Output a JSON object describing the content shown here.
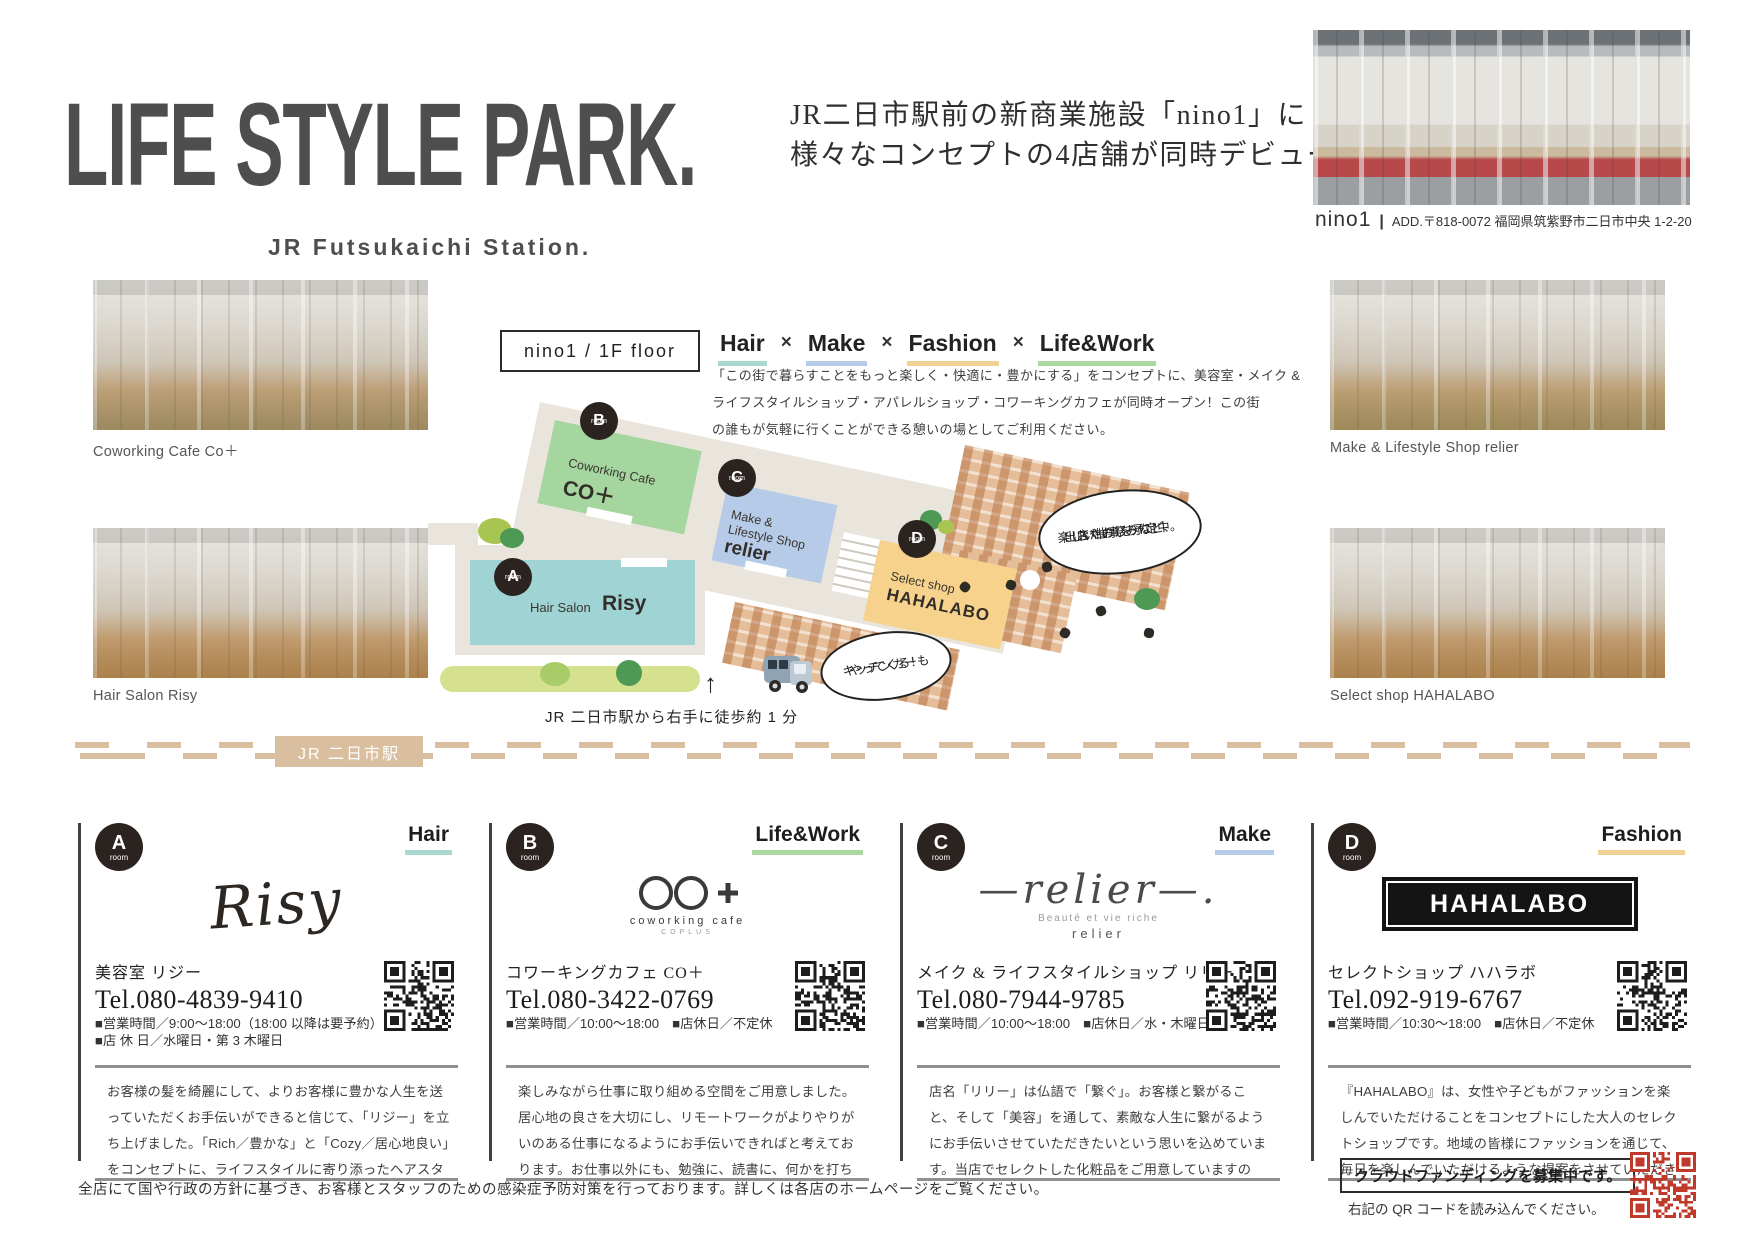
{
  "theme": {
    "ink": "#4e4e4e",
    "hair": "#a8d8d0",
    "make": "#b6cbe8",
    "fashion": "#f0d294",
    "lifework": "#abd8a0",
    "room_a": "#9fd3d4",
    "room_b": "#a5d6a0",
    "room_c": "#b6cbe8",
    "room_d": "#f6d28c",
    "station": "#d9bf9f",
    "qr_dark": "#1d1d1b",
    "qr_red": "#c0392b"
  },
  "header": {
    "title": "LIFE STYLE PARK.",
    "subtitle": "JR Futsukaichi Station.",
    "tagline1": "JR二日市駅前の新商業施設「nino1」に",
    "tagline2": "様々なコンセプトの4店舗が同時デビュー！",
    "facility_name": "nino1",
    "pipe": "|",
    "address": "ADD.〒818-0072 福岡県筑紫野市二日市中央 1-2-20"
  },
  "gallery": {
    "captions": {
      "coworking": "Coworking Cafe Co＋",
      "hair": "Hair Salon Risy",
      "make": "Make & Lifestyle Shop relier",
      "select": "Select shop HAHALABO"
    }
  },
  "map": {
    "floor_label": "nino1 / 1F floor",
    "cat_hair": "Hair",
    "cat_make": "Make",
    "cat_fashion": "Fashion",
    "cat_lifework": "Life&Work",
    "cat_sep": "×",
    "desc1": "「この街で暮らすことをもっと楽しく・快適に・豊かにする」をコンセプトに、美容室・メイク &",
    "desc2": "ライフスタイルショップ・アパレルショップ・コワーキングカフェが同時オープン！この街",
    "desc3": "の誰もが気軽に行くことができる憩いの場としてご利用ください。",
    "rooms": {
      "a": {
        "letter": "A",
        "sub": "room",
        "type": "Hair Salon",
        "name": "Risy"
      },
      "b": {
        "letter": "B",
        "sub": "room",
        "type": "Coworking Cafe",
        "name": "CO＋"
      },
      "c": {
        "letter": "C",
        "sub": "room",
        "type1": "Make &",
        "type2": "Lifestyle Shop",
        "name": "relier"
      },
      "d": {
        "letter": "D",
        "sub": "room",
        "type": "Select shop",
        "name": "HAHALABO"
      }
    },
    "bubble_event1": "出店やお祭りなど、",
    "bubble_event2": "楽しい催事を予定中。",
    "bubble_event3": "おたのしみに！",
    "bubble_kitchen1": "キッチンカーも",
    "bubble_kitchen2": "やってくる！",
    "arrow": "↑",
    "walk_note": "JR 二日市駅から右手に徒歩約 1 分",
    "station_label": "JR 二日市駅"
  },
  "shops": [
    {
      "letter": "A",
      "room_sub": "room",
      "category": "Hair",
      "logo": "Risy",
      "name_jp": "美容室 リジー",
      "tel": "Tel.080-4839-9410",
      "line1": "■営業時間／9:00～18:00（18:00 以降は要予約）",
      "line2": "■店 休 日／水曜日・第 3 木曜日",
      "desc": "お客様の髪を綺麗にして、よりお客様に豊かな人生を送っていただくお手伝いができると信じて、「リジー」を立ち上げました。「Rich／豊かな」と「Cozy／居心地良い」をコンセプトに、ライフスタイルに寄り添ったヘアスタイルの提案をさせていただきます。"
    },
    {
      "letter": "B",
      "room_sub": "room",
      "category": "Life&Work",
      "logo_sub1": "coworking cafe",
      "logo_sub2": "COPLUS",
      "name_jp": "コワーキングカフェ CO＋",
      "tel": "Tel.080-3422-0769",
      "line1": "■営業時間／10:00～18:00　■店休日／不定休",
      "desc": "楽しみながら仕事に取り組める空間をご用意しました。居心地の良さを大切にし、リモートワークがよりやりがいのある仕事になるようにお手伝いできればと考えております。お仕事以外にも、勉強に、読書に、何かを打ち込める場所になればと思っております。"
    },
    {
      "letter": "C",
      "room_sub": "room",
      "category": "Make",
      "logo": "relier",
      "logo_sub1": "Beauté et vie riche",
      "logo_sub2": "relier",
      "name_jp": "メイク & ライフスタイルショップ リリー",
      "tel": "Tel.080-7944-9785",
      "line1": "■営業時間／10:00～18:00　■店休日／水・木曜日",
      "desc": "店名「リリー」は仏語で「繋ぐ」。お客様と繋がること、そして「美容」を通して、素敵な人生に繋がるようにお手伝いさせていただきたいという思いを込めています。当店でセレクトした化粧品をご用意していますので、キレイを見つけにいらしてください。"
    },
    {
      "letter": "D",
      "room_sub": "room",
      "category": "Fashion",
      "logo": "HAHALABO",
      "name_jp": "セレクトショップ ハハラボ",
      "tel": "Tel.092-919-6767",
      "line1": "■営業時間／10:30～18:00　■店休日／不定休",
      "desc": "『HAHALABO』は、女性や子どもがファッションを楽しんでいただけることをコンセプトにした大人のセレクトショップです。地域の皆様にファッションを通じて、毎日を楽しんでいただけるような提案をさせていただきます。"
    }
  ],
  "footer": {
    "note": "全店にて国や行政の方針に基づき、お客様とスタッフのための感染症予防対策を行っております。詳しくは各店のホームページをご覧ください。",
    "cf_line1": "クラウドファンディングを募集中です。",
    "cf_line2": "右記の QR コードを読み込んでください。"
  }
}
